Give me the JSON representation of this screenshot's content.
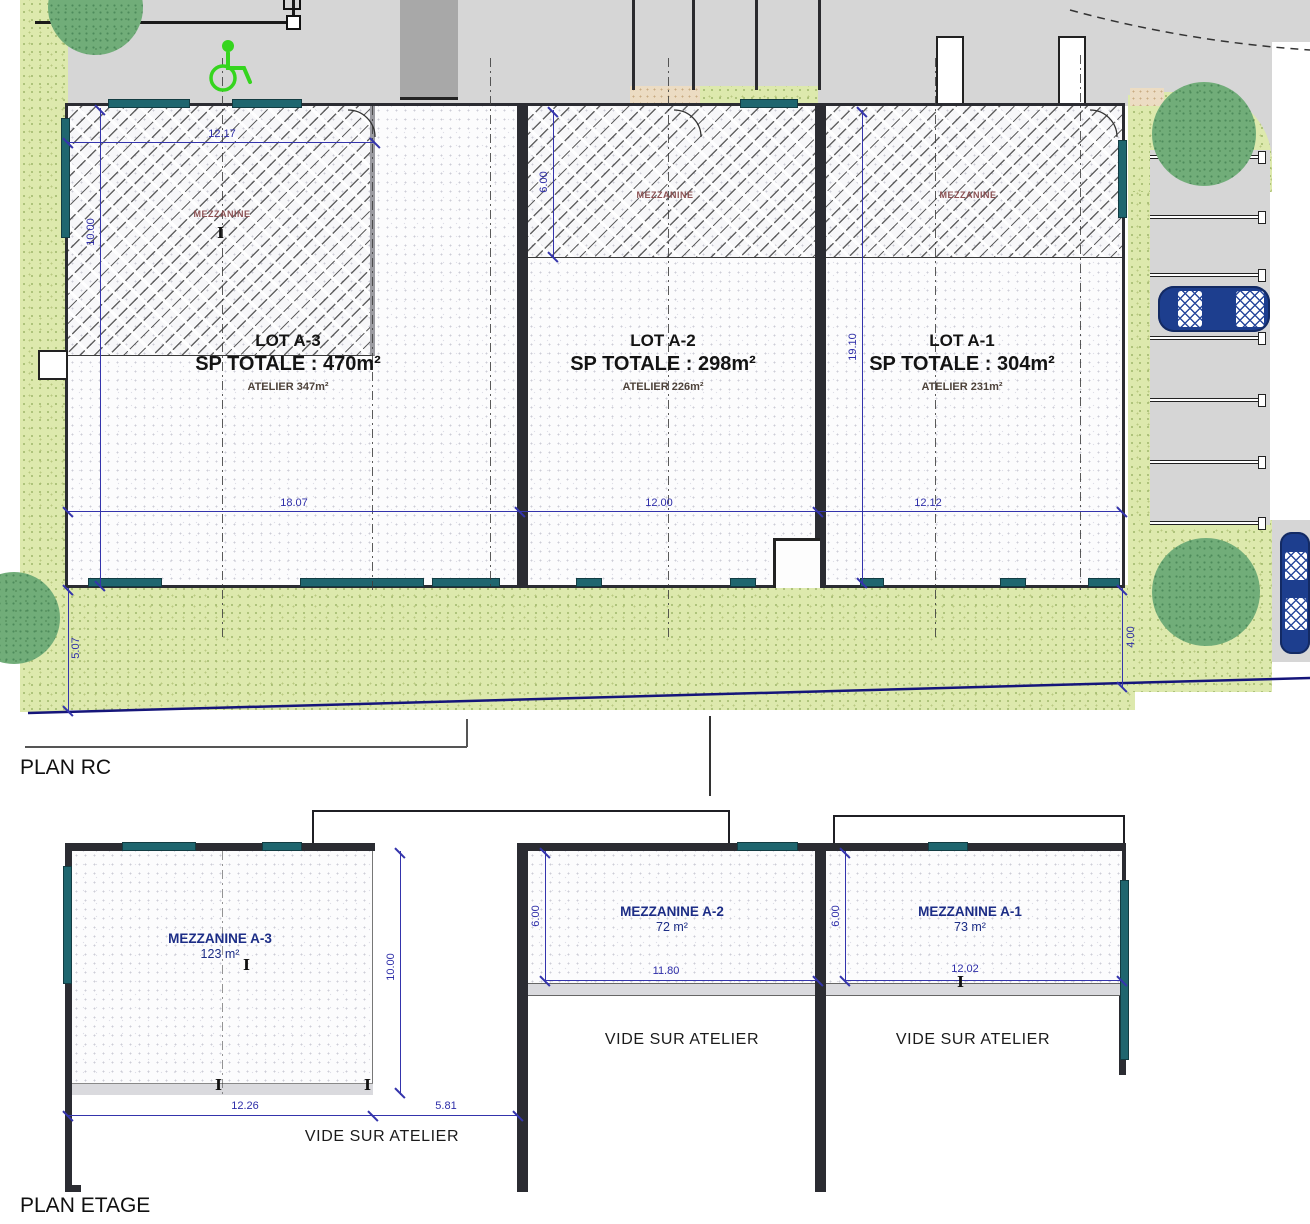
{
  "plan_rc": {
    "title": "PLAN RC",
    "lots": [
      {
        "name": "LOT A-3",
        "sp_totale": "SP TOTALE : 470m²",
        "atelier": "ATELIER 347m²",
        "mezzanine": "MEZZANINE"
      },
      {
        "name": "LOT A-2",
        "sp_totale": "SP TOTALE : 298m²",
        "atelier": "ATELIER 226m²",
        "mezzanine": "MEZZANINE"
      },
      {
        "name": "LOT A-1",
        "sp_totale": "SP TOTALE : 304m²",
        "atelier": "ATELIER 231m²",
        "mezzanine": "MEZZANINE"
      }
    ],
    "dimensions": {
      "mezz_a3_width": "12.17",
      "mezz_a3_depth": "10.00",
      "mezz_a2_depth": "6.00",
      "lot_a1_depth": "19.10",
      "lot_a3_width": "18.07",
      "lot_a2_width": "12.00",
      "lot_a1_width": "12.12",
      "setback_left": "5.07",
      "setback_right": "4.00"
    }
  },
  "plan_etage": {
    "title": "PLAN ETAGE",
    "mezzanines": [
      {
        "name": "MEZZANINE A-3",
        "area": "123 m²"
      },
      {
        "name": "MEZZANINE A-2",
        "area": "72 m²"
      },
      {
        "name": "MEZZANINE A-1",
        "area": "73 m²"
      }
    ],
    "void_label": "VIDE SUR ATELIER",
    "dimensions": {
      "mezz_a3_depth": "10.00",
      "mezz_a3_width": "12.26",
      "void_width": "5.81",
      "mezz_a2_depth": "6.00",
      "mezz_a2_width": "11.80",
      "mezz_a1_depth": "6.00",
      "mezz_a1_width": "12.02"
    }
  },
  "colors": {
    "grass": "#dde9ad",
    "tree": "#71ad79",
    "pavement": "#d6d6d6",
    "wall": "#2b2c32",
    "window_teal": "#1f666f",
    "dimension_blue": "#3434ac",
    "car_blue": "#1d3e8e",
    "wheelchair_green": "#35d51e"
  }
}
